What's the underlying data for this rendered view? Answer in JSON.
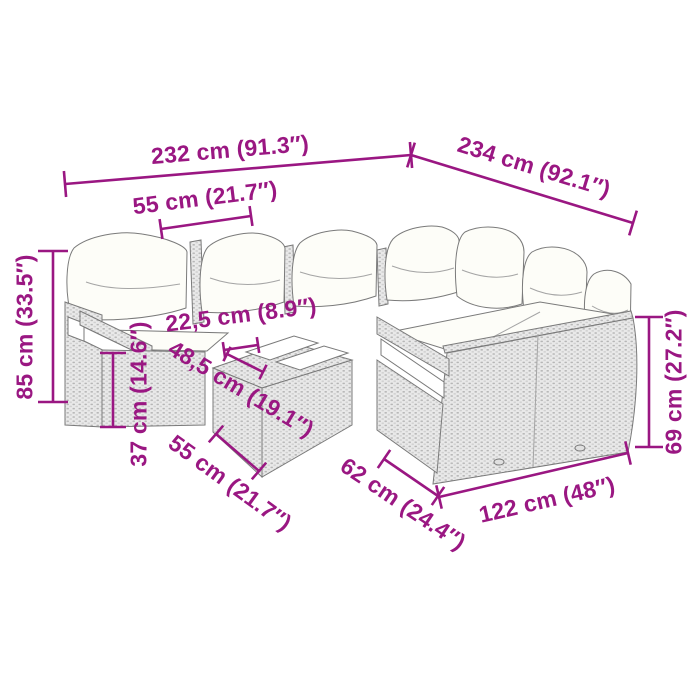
{
  "diagram": {
    "type": "furniture-dimension-diagram",
    "subject": "rattan corner sofa set with ottoman table",
    "colors": {
      "accent": "#9A1782",
      "background": "#FFFFFF",
      "outline": "#7A7A7A",
      "wicker_fill": "#E9E9E9",
      "wicker_weave": "#B6B6B6",
      "cushion": "#FDFDF8"
    },
    "labels": {
      "overall_width": "232 cm (91.3″)",
      "overall_depth": "234 cm (92.1″)",
      "seat_width": "55 cm (21.7″)",
      "overall_height": "85 cm (33.5″)",
      "seat_height": "37 cm (14.6″)",
      "table_height": "22,5 cm (8.9″)",
      "table_length": "48,5 cm (19.1″)",
      "seat_depth": "55 cm (21.7″)",
      "bench_depth": "62 cm (24.4″)",
      "bench_width": "122 cm (48″)",
      "back_height": "69 cm (27.2″)"
    }
  }
}
